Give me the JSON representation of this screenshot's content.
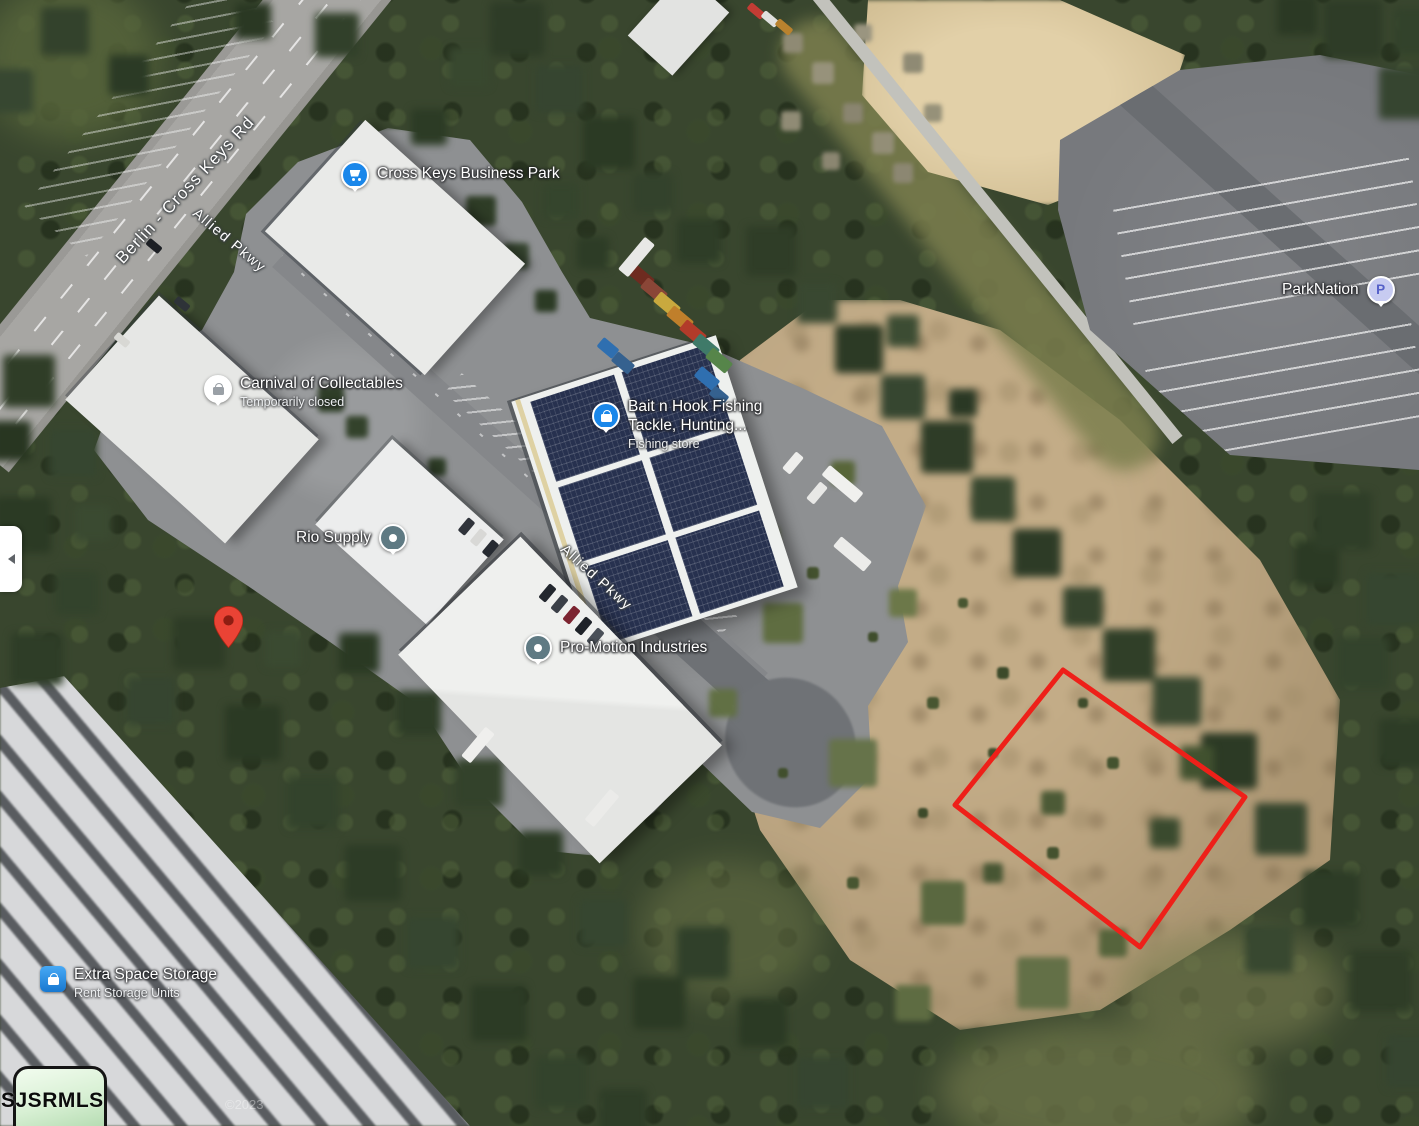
{
  "map": {
    "view_type": "satellite",
    "roads": [
      {
        "label": "Berlin - Cross Keys Rd"
      },
      {
        "label": "Allied Pkwy"
      },
      {
        "label": "Allied Pkwy"
      }
    ],
    "places": [
      {
        "name": "Cross Keys Business Park",
        "icon": "shopping-cart"
      },
      {
        "name": "Carnival of Collectables",
        "status": "Temporarily closed",
        "icon": "shopping-bag-closed"
      },
      {
        "name": "Bait n Hook Fishing Tackle, Hunting...",
        "category": "Fishing store",
        "icon": "shopping-bag"
      },
      {
        "name": "Rio Supply",
        "icon": "generic-place"
      },
      {
        "name": "Pro-Motion Industries",
        "icon": "generic-place"
      },
      {
        "name": "ParkNation",
        "icon": "parking",
        "icon_letter": "P"
      },
      {
        "name": "Extra Space Storage",
        "subtitle": "Rent Storage Units",
        "icon": "storage-lock"
      }
    ],
    "property_marker": {
      "color": "#EA4335"
    },
    "parcel_outline": {
      "color": "#EE2019"
    },
    "watermark": "SJSRMLS",
    "copyright": "©2023"
  },
  "side_panel": {
    "state": "collapsed"
  }
}
